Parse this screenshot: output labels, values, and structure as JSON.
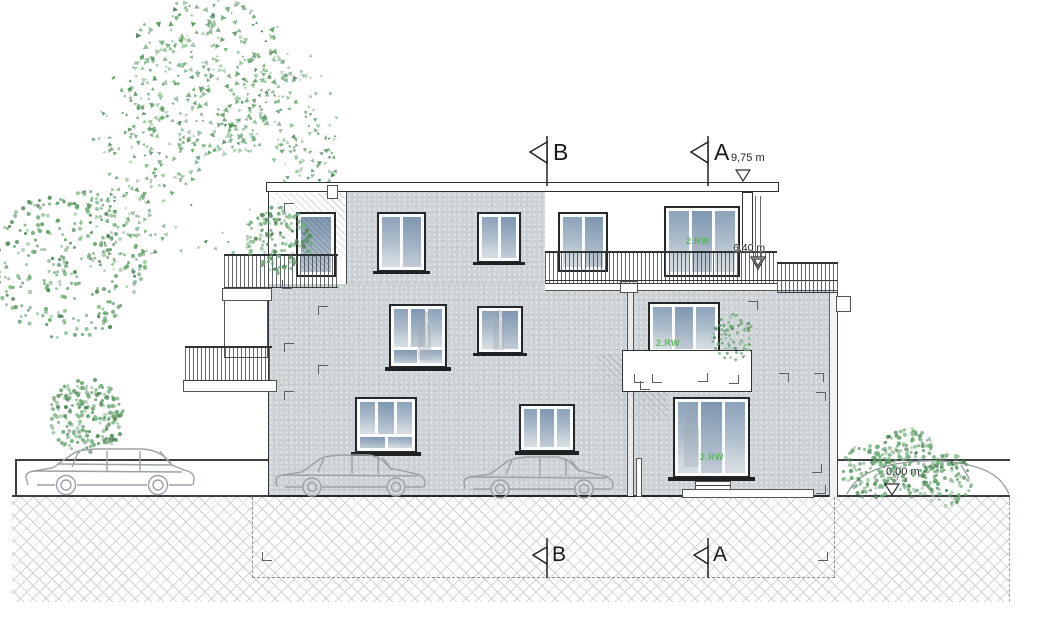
{
  "annotations": {
    "section_a_label": "A",
    "section_b_label": "B",
    "level_roof": "9,75 m",
    "level_upper_terrace": "6,40 m",
    "level_ground": "0,00 m",
    "escape_route_top": "2.RW",
    "escape_route_middle": "2.RW",
    "escape_route_ground": "2.RW"
  },
  "colors": {
    "facade_gray": "#ccd2d5",
    "glazing_blue": "#8ba2ba",
    "foliage_green": "#7fa884",
    "linework": "#2f3335",
    "ground_hatch": "#ced2d3",
    "escape_route_green": "#54b357"
  }
}
